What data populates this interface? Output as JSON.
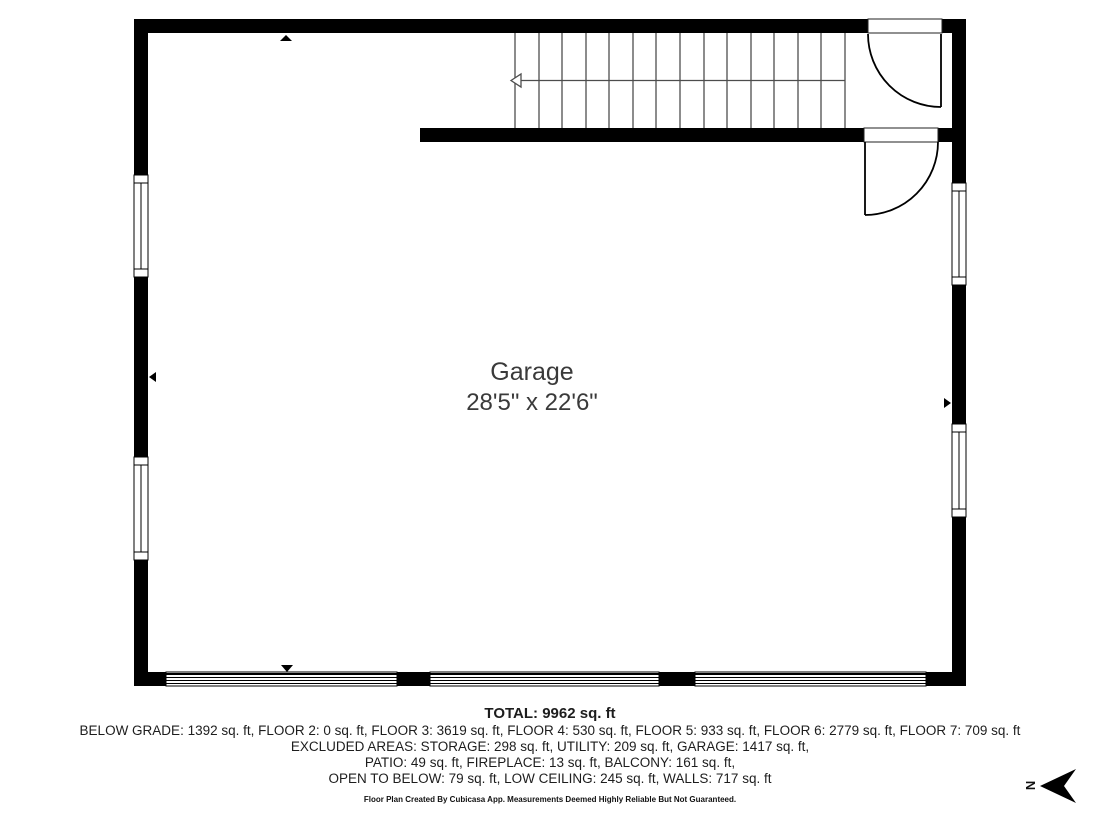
{
  "floor_plan": {
    "room_label": {
      "name": "Garage",
      "dimensions": "28'5\" x 22'6\""
    },
    "compass": {
      "label": "N"
    }
  },
  "summary": {
    "total": "TOTAL: 9962 sq. ft",
    "floors": "BELOW GRADE: 1392 sq. ft, FLOOR 2: 0 sq. ft, FLOOR 3: 3619 sq. ft, FLOOR 4: 530 sq. ft, FLOOR 5: 933 sq. ft, FLOOR 6: 2779 sq. ft, FLOOR 7: 709 sq. ft",
    "excluded_line_1": "EXCLUDED AREAS: STORAGE: 298 sq. ft, UTILITY: 209 sq. ft, GARAGE: 1417 sq. ft,",
    "excluded_line_2": "PATIO: 49 sq. ft, FIREPLACE: 13 sq. ft, BALCONY: 161 sq. ft,",
    "excluded_line_3": "OPEN TO BELOW: 79 sq. ft, LOW CEILING: 245 sq. ft, WALLS: 717 sq. ft",
    "disclaimer": "Floor Plan Created By Cubicasa App. Measurements Deemed Highly Reliable But Not Guaranteed."
  },
  "colors": {
    "wall": "#000000",
    "stair_line": "#4d4d4d",
    "door_line": "#000000",
    "room_text": "#3a3a3a",
    "summary_text": "#1d1d1d",
    "background": "#ffffff"
  }
}
